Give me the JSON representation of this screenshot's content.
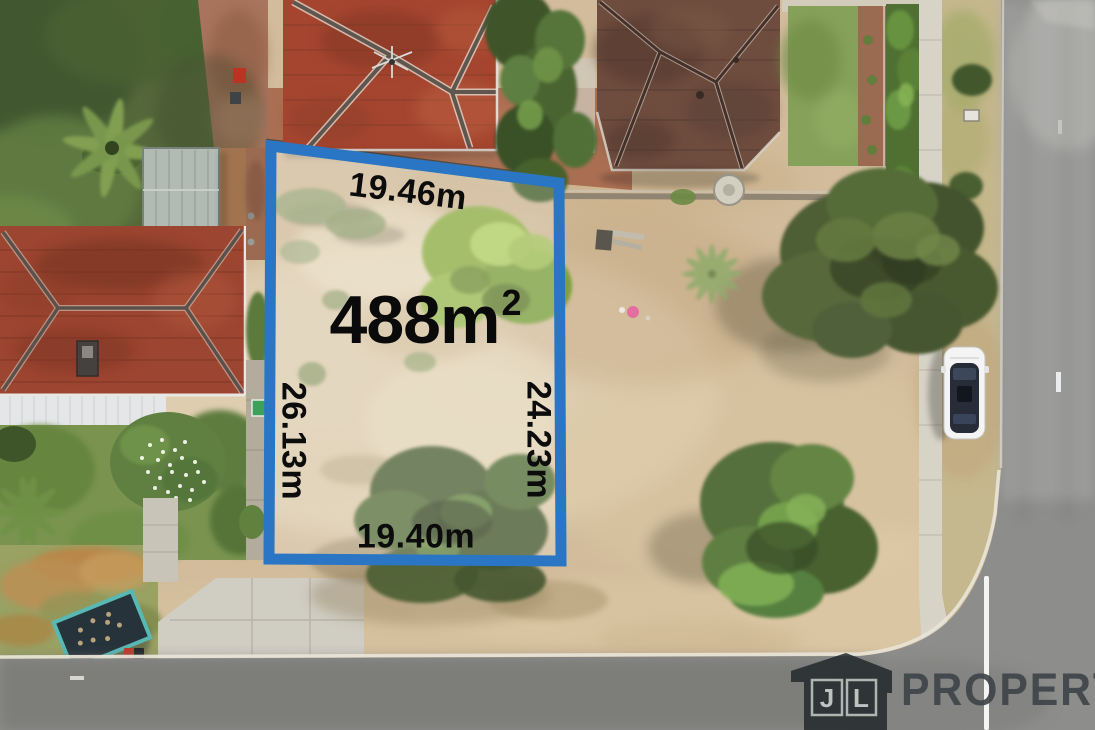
{
  "scene": {
    "kind": "aerial-drone-photo",
    "subject": "vacant residential land lot outlined in blue"
  },
  "lot": {
    "area": "488m",
    "area_superscript": "2",
    "dimensions": {
      "top": "19.46m",
      "left": "26.13m",
      "right": "24.23m",
      "bottom": "19.40m"
    },
    "boundary_color": "#2a76c4",
    "label_color": "#0c0c0c"
  },
  "watermark": {
    "house_icon": "house-icon",
    "letters": {
      "left": "J",
      "right": "L"
    },
    "wordmark": "PROPERTY",
    "color": "#3e4449"
  }
}
